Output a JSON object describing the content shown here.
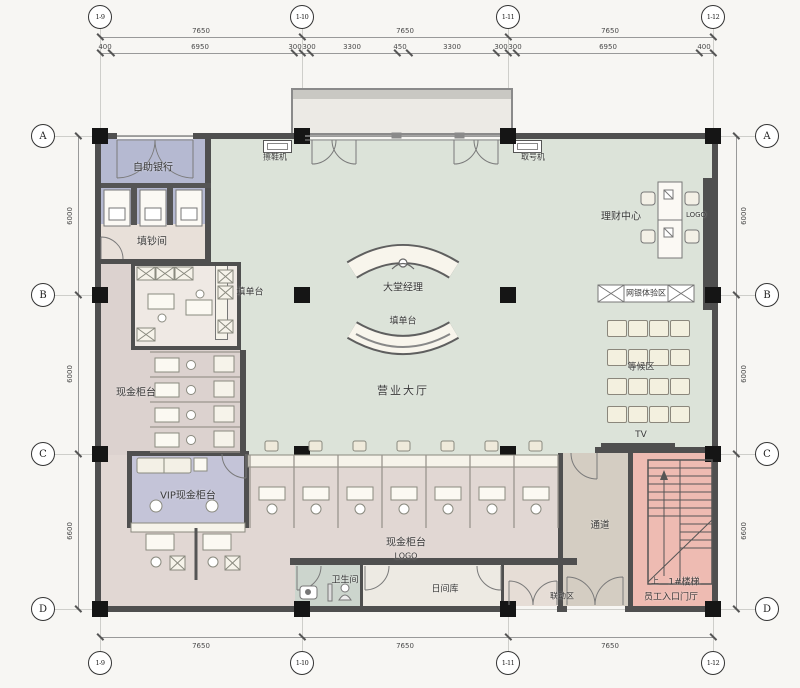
{
  "drawing": {
    "type": "bank-branch-floor-plan",
    "grid": {
      "cols_top": [
        "1-9",
        "1-10",
        "1-11",
        "1-12"
      ],
      "cols_bottom": [
        "1-9",
        "1-10",
        "1-11",
        "1-12"
      ],
      "rows_left": [
        "A",
        "B",
        "C",
        "D"
      ],
      "rows_right": [
        "A",
        "B",
        "C",
        "D"
      ]
    },
    "dims": {
      "top_bays": [
        "7650",
        "7650",
        "7650"
      ],
      "top_sub": [
        "400",
        "6950",
        "300",
        "300",
        "3300",
        "450",
        "3300",
        "300",
        "300",
        "6950",
        "400"
      ],
      "bottom_bays": [
        "7650",
        "7650",
        "7650"
      ],
      "left_rows": [
        "6000",
        "6000",
        "6600"
      ],
      "right_rows": [
        "6000",
        "6000",
        "6600"
      ]
    },
    "rooms": {
      "self_service_bank": "自助银行",
      "cash_filling_room": "填钞间",
      "form_counter_left": "填单台",
      "lobby_manager": "大堂经理",
      "form_counter_center": "填单台",
      "business_hall": "营业大厅",
      "wealth_center": "理财中心",
      "logo_wall": "LOGO",
      "ebank_zone": "网银体验区",
      "waiting_area": "等候区",
      "tv": "TV",
      "cash_counter_left": "现金柜台",
      "vip_cash_counter": "VIP现金柜台",
      "cash_counter_bottom": "现金柜台",
      "logo_bottom": "LOGO",
      "washroom": "卫生间",
      "day_vault": "日间库",
      "interlock_zone": "联动区",
      "corridor": "通道",
      "stair_up_mark": "上",
      "stair_1": "1#楼梯",
      "staff_entrance_hall": "员工入口门厅"
    },
    "equipment": {
      "shoe_polisher": "擦鞋机",
      "ticket_machine": "取号机"
    },
    "colors": {
      "wall": "#4f4f4f",
      "hall_green": "#dce3d9",
      "lavender": "#b5b9d1",
      "vip_lavender": "#c4c4d8",
      "work_pink": "#dcd2cf",
      "counter_band": "#e1d7d3",
      "stair_pink": "#eebbb2",
      "corridor_tan": "#d4cdc2",
      "washroom_green": "#ccd5cd",
      "vault_cream": "#edeae3"
    }
  }
}
